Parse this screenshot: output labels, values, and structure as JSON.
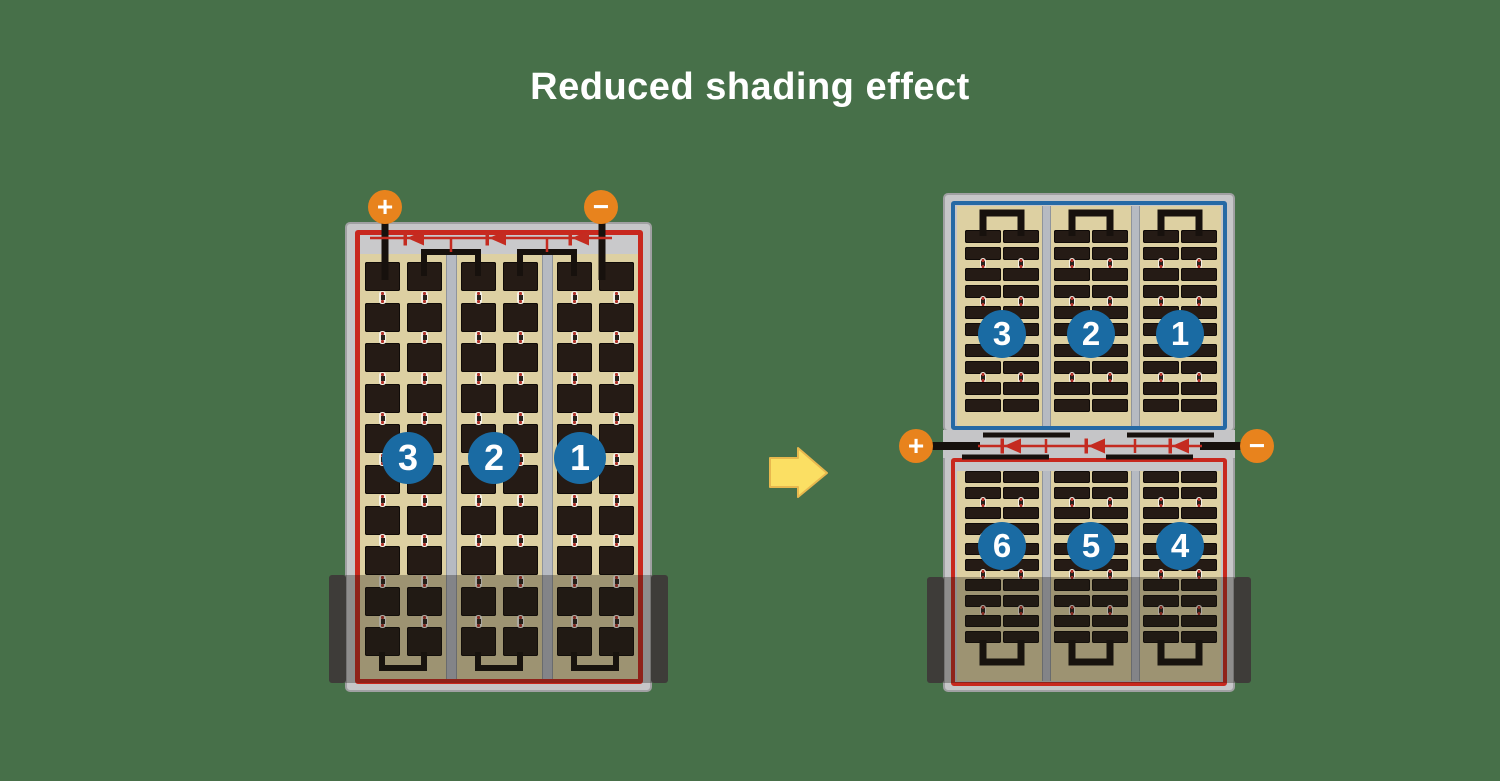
{
  "title": "Reduced shading effect",
  "background_color": "#477049",
  "colors": {
    "panel_frame": "#c6c6c8",
    "panel_red_border": "#c8281e",
    "panel_blue_border": "#2569a5",
    "cell_background": "#ddd0a2",
    "cell_dark": "#251b15",
    "wire_black": "#17110d",
    "diode_red": "#c42b20",
    "terminal_orange": "#e8831d",
    "string_badge_blue": "#1a6ba3",
    "arrow_yellow": "#fbdf63",
    "arrow_outline": "#e8b84e"
  },
  "left_panel": {
    "type": "full-cell module",
    "terminals": {
      "positive": "+",
      "negative": "−"
    },
    "cell_strings": [
      "3",
      "2",
      "1"
    ],
    "groups": 3,
    "columns_per_group": 2,
    "rows": 10,
    "bypass_diodes": 3,
    "shaded_bottom": true
  },
  "right_panel": {
    "type": "half-cell module",
    "terminals": {
      "positive": "+",
      "negative": "−"
    },
    "top_half": {
      "cell_strings": [
        "3",
        "2",
        "1"
      ],
      "strip_row_pairs": 5
    },
    "bottom_half": {
      "cell_strings": [
        "6",
        "5",
        "4"
      ],
      "strip_row_pairs": 5
    },
    "bypass_diodes": 3,
    "shaded_bottom": true
  },
  "arrow": {
    "direction": "right"
  }
}
